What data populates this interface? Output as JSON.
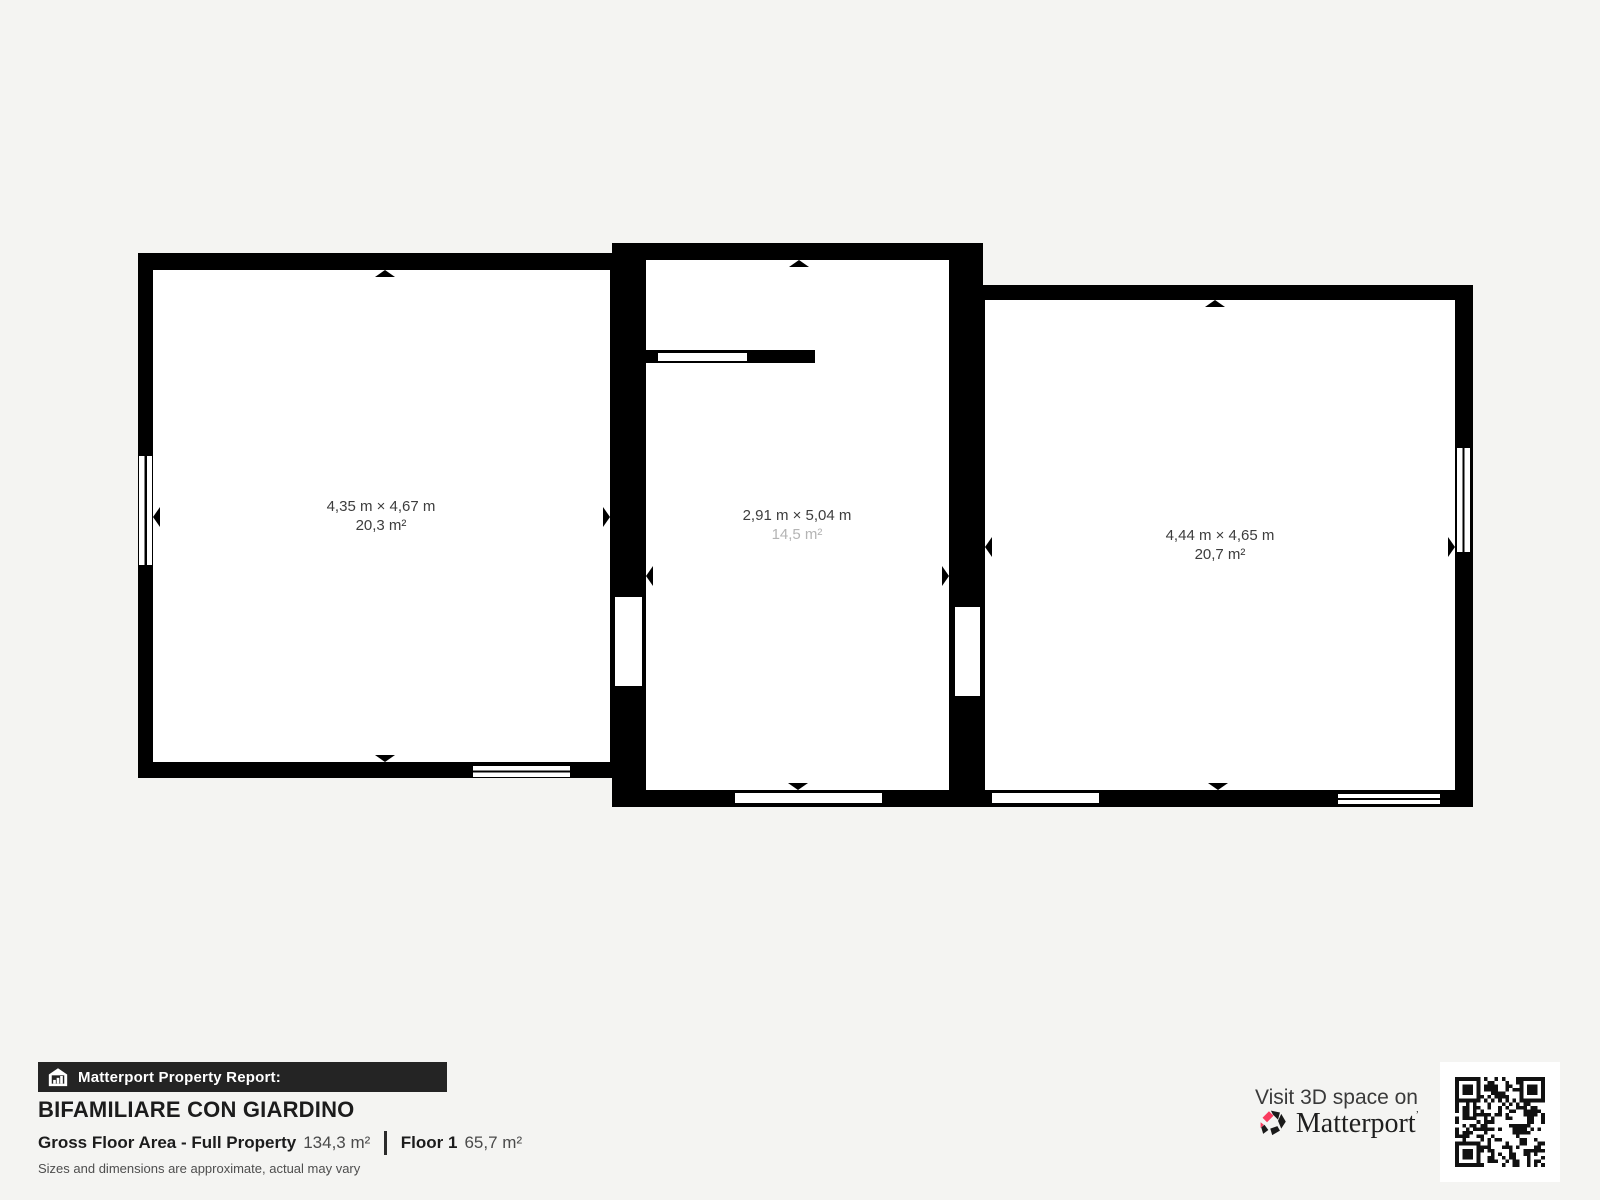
{
  "plan": {
    "rooms": [
      {
        "id": "left",
        "dimensions": "4,35 m × 4,67 m",
        "area": "20,3 m²"
      },
      {
        "id": "middle",
        "dimensions": "2,91 m × 5,04 m",
        "area": "14,5 m²"
      },
      {
        "id": "right",
        "dimensions": "4,44 m × 4,65 m",
        "area": "20,7 m²"
      }
    ]
  },
  "report": {
    "banner_label": "Matterport Property Report:",
    "property_name": "BIFAMILIARE CON GIARDINO",
    "area_label": "Gross Floor Area - Full Property",
    "area_value": "134,3 m²",
    "floor_label": "Floor 1",
    "floor_value": "65,7 m²",
    "disclaimer": "Sizes and dimensions are approximate, actual may vary"
  },
  "cta": {
    "visit_label": "Visit 3D space on",
    "brand": "Matterport",
    "brand_mark": "’"
  },
  "icons": {
    "banner_icon": "house-bars-icon",
    "brand_icon": "matterport-pinwheel-icon",
    "qr": "qr-code"
  },
  "colors": {
    "background": "#f4f4f2",
    "wall": "#000000",
    "banner_bg": "#242424",
    "brand_pink": "#f93b5e",
    "room_label": "#3d3d3d",
    "room_label_muted": "#b4b4b4"
  }
}
